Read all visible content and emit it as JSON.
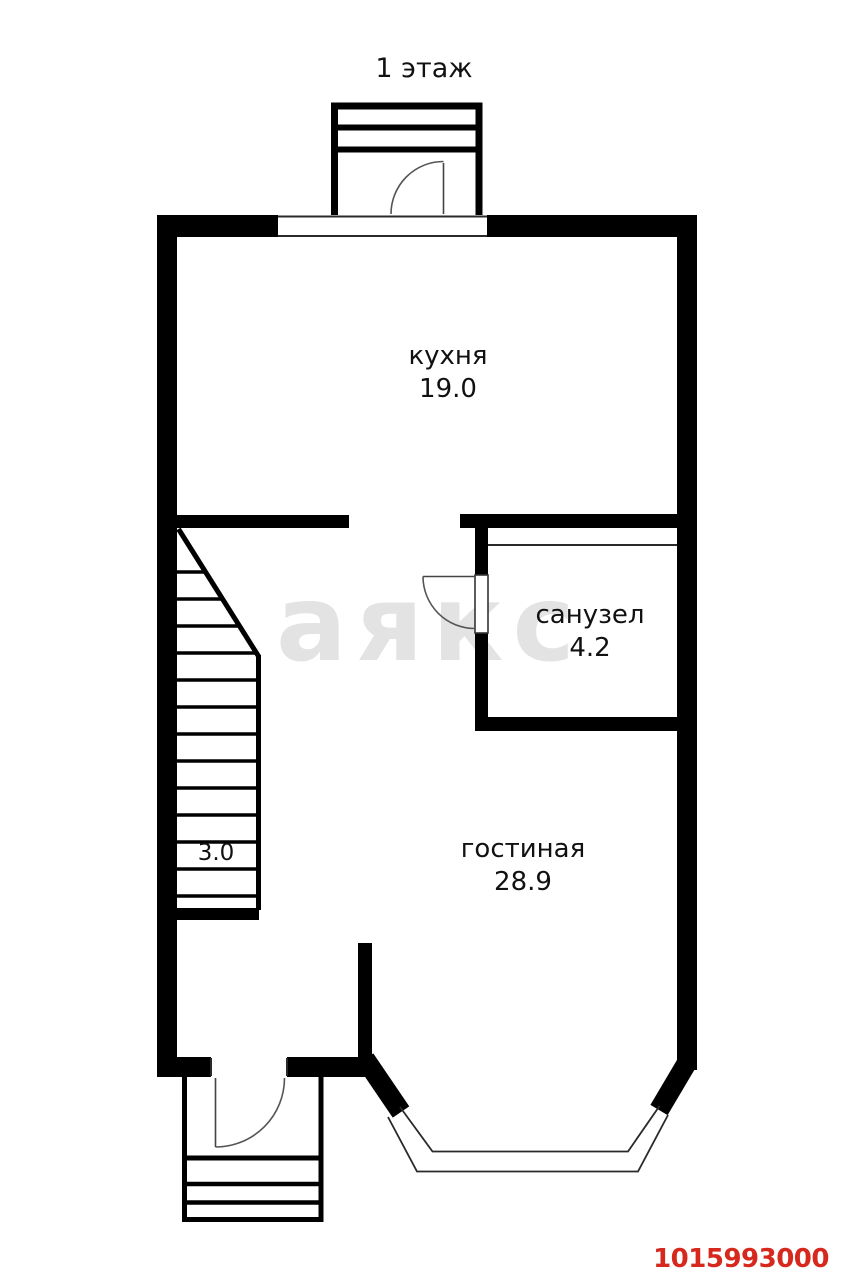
{
  "floor_plan": {
    "floor_title": "1 этаж",
    "rooms": [
      {
        "name": "кухня",
        "area": "19.0"
      },
      {
        "name": "санузел",
        "area": "4.2"
      },
      {
        "name": "гостиная",
        "area": "28.9"
      }
    ],
    "stairs_label": "3.0",
    "watermark_text": "аякс",
    "listing_id": "1015993000",
    "colors": {
      "walls": "#000000",
      "background": "#ffffff",
      "watermark": "#e3e3e3",
      "listing_id_red": "#d7281d"
    }
  }
}
